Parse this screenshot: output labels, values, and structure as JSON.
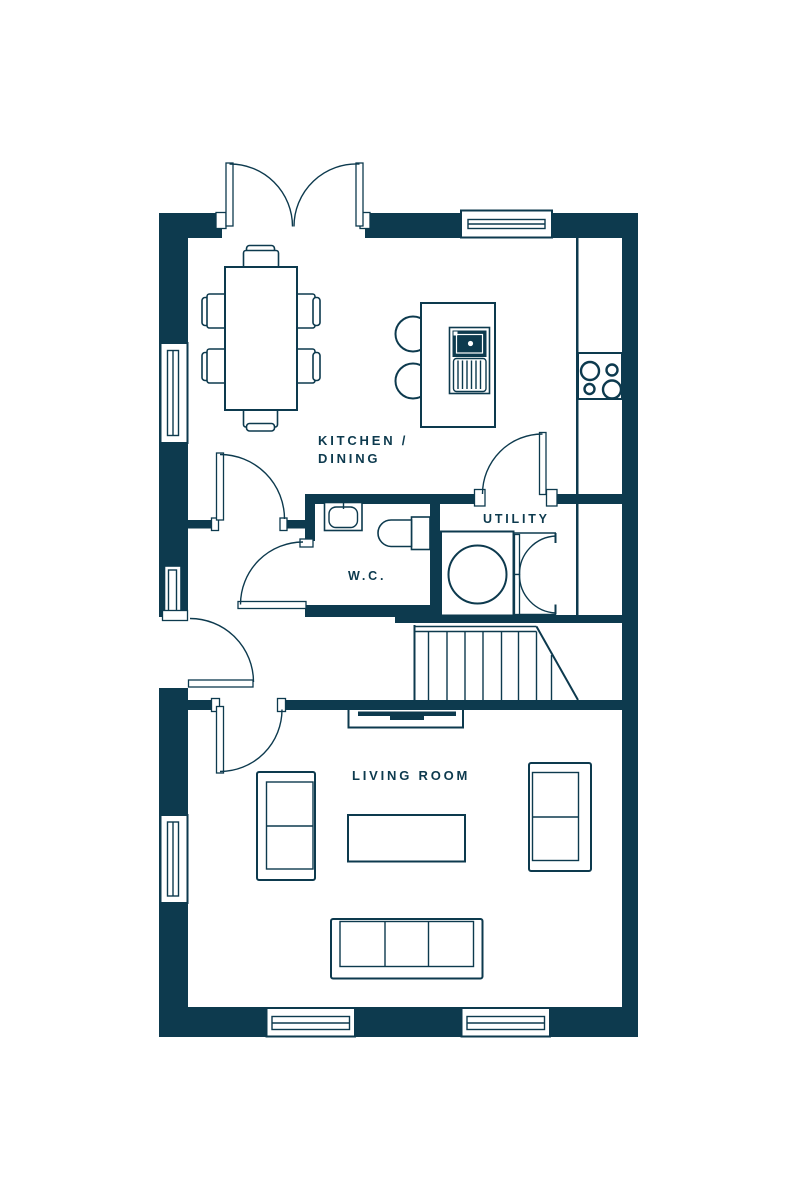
{
  "colors": {
    "ink": "#0d3a4e",
    "background": "#ffffff"
  },
  "rooms": {
    "kitchen_dining": {
      "label_line1": "KITCHEN /",
      "label_line2": "DINING"
    },
    "utility": {
      "label": "UTILITY"
    },
    "wc": {
      "label": "W.C."
    },
    "living_room": {
      "label": "LIVING ROOM"
    }
  },
  "fixtures": [
    "french-doors",
    "dining-table",
    "dining-chairs",
    "kitchen-island",
    "island-sink",
    "breakfast-stools",
    "worktop",
    "hob",
    "wc-basin",
    "wc-toilet",
    "washing-machine",
    "utility-cupboard",
    "staircase",
    "tv-unit",
    "sofa-left",
    "sofa-right",
    "sofa-bottom",
    "coffee-table",
    "windows",
    "doors"
  ]
}
